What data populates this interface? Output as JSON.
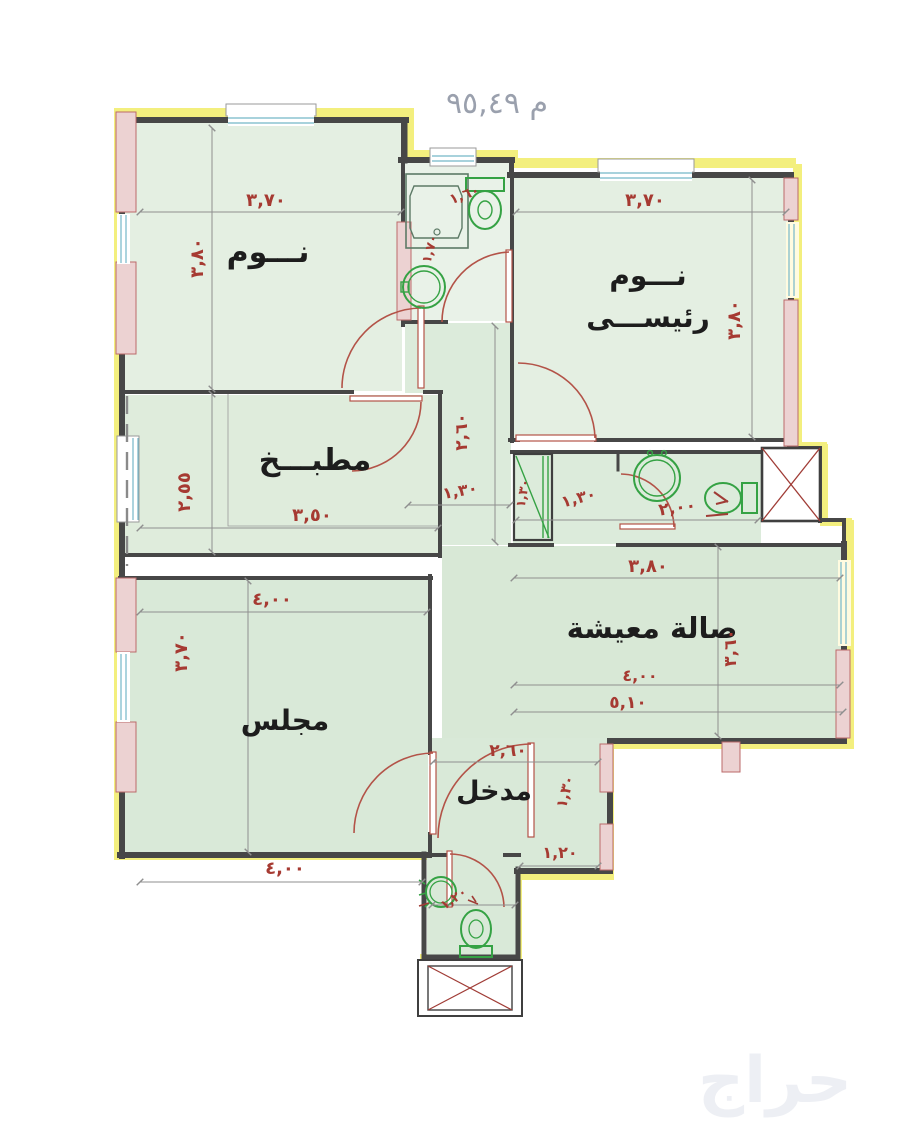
{
  "header": {
    "area_text": "م ٩٥,٤٩"
  },
  "watermark": {
    "text": "حراج"
  },
  "rooms": {
    "bedroom": {
      "label": "نـــوم",
      "width": "٣,٧٠",
      "height": "٣,٨٠"
    },
    "master": {
      "label_line1": "نـــوم",
      "label_line2": "رئيســـى",
      "width": "٣,٧٠",
      "height": "٣,٨٠"
    },
    "kitchen": {
      "label": "مطبـــخ",
      "width": "٣,٥٠",
      "height": "٢,٥٥"
    },
    "majlis": {
      "label": "مجلس",
      "width": "٤,٠٠",
      "height": "٣,٧٠"
    },
    "living": {
      "label": "صالة معيشة",
      "upper_width": "٣,٨٠",
      "width": "٤,٠٠",
      "total_width": "٥,١٠",
      "height": "٣,٦٠"
    },
    "entrance": {
      "label": "مدخل",
      "width": "٢,٦٠",
      "door": "١,٣٠",
      "side": "١,٢٠"
    },
    "bath_top": {
      "width": "١,٦٠",
      "depth": "١,٧٠"
    },
    "hall": {
      "length": "٢,٦٠",
      "width": "١,٣٠",
      "closet_width": "١,٣٠",
      "closet_depth": "١,٣٠"
    },
    "wc": {
      "width": "٢,٠٠"
    },
    "wc_bottom": {
      "width": "١,٢٠"
    },
    "plot": {
      "bottom_width": "٤,٠٠"
    }
  }
}
